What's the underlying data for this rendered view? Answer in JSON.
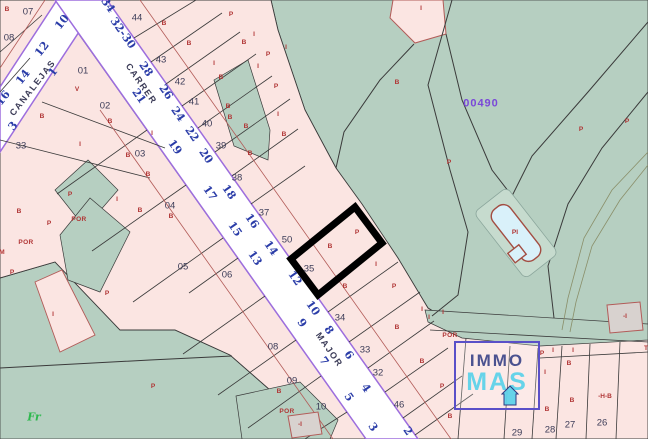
{
  "map": {
    "region_code": {
      "t": "00490",
      "x": 481,
      "y": 104
    },
    "street_names": [
      {
        "t": "CANALEJAS",
        "x": 33,
        "y": 88,
        "r": -52
      },
      {
        "t": "CARRER",
        "x": 141,
        "y": 84,
        "r": 55
      },
      {
        "t": "MAJOR",
        "x": 329,
        "y": 350,
        "r": 55
      }
    ],
    "house_numbers": [
      {
        "t": "34",
        "x": 108,
        "y": 5,
        "r": 55
      },
      {
        "t": "32-30",
        "x": 123,
        "y": 33,
        "r": 55
      },
      {
        "t": "28",
        "x": 146,
        "y": 69,
        "r": 55
      },
      {
        "t": "26",
        "x": 166,
        "y": 92,
        "r": 55
      },
      {
        "t": "24",
        "x": 178,
        "y": 114,
        "r": 55
      },
      {
        "t": "22",
        "x": 192,
        "y": 134,
        "r": 55
      },
      {
        "t": "20",
        "x": 206,
        "y": 156,
        "r": 55
      },
      {
        "t": "18",
        "x": 229,
        "y": 192,
        "r": 55
      },
      {
        "t": "16",
        "x": 252,
        "y": 221,
        "r": 55
      },
      {
        "t": "14",
        "x": 271,
        "y": 248,
        "r": 55
      },
      {
        "t": "12",
        "x": 295,
        "y": 278,
        "r": 55
      },
      {
        "t": "10",
        "x": 313,
        "y": 308,
        "r": 55
      },
      {
        "t": "8",
        "x": 329,
        "y": 330,
        "r": 55
      },
      {
        "t": "6",
        "x": 349,
        "y": 355,
        "r": 55
      },
      {
        "t": "4",
        "x": 366,
        "y": 388,
        "r": 55
      },
      {
        "t": "2",
        "x": 408,
        "y": 431,
        "r": 55
      },
      {
        "t": "21",
        "x": 139,
        "y": 96,
        "r": 55
      },
      {
        "t": "19",
        "x": 175,
        "y": 147,
        "r": 55
      },
      {
        "t": "17",
        "x": 210,
        "y": 193,
        "r": 55
      },
      {
        "t": "15",
        "x": 235,
        "y": 229,
        "r": 55
      },
      {
        "t": "13",
        "x": 255,
        "y": 258,
        "r": 55
      },
      {
        "t": "9",
        "x": 302,
        "y": 323,
        "r": 55
      },
      {
        "t": "7",
        "x": 324,
        "y": 361,
        "r": 55
      },
      {
        "t": "5",
        "x": 349,
        "y": 397,
        "r": 55
      },
      {
        "t": "3",
        "x": 373,
        "y": 427,
        "r": 55
      },
      {
        "t": "16",
        "x": 3,
        "y": 98,
        "r": -52
      },
      {
        "t": "14",
        "x": 23,
        "y": 77,
        "r": -52
      },
      {
        "t": "12",
        "x": 42,
        "y": 49,
        "r": -52
      },
      {
        "t": "10",
        "x": 62,
        "y": 22,
        "r": -52
      },
      {
        "t": "3",
        "x": 13,
        "y": 126,
        "r": -52
      },
      {
        "t": "1",
        "x": 53,
        "y": 72,
        "r": -52
      }
    ],
    "parcel_numbers": [
      {
        "t": "07",
        "x": 28,
        "y": 12
      },
      {
        "t": "08",
        "x": 9,
        "y": 38
      },
      {
        "t": "33",
        "x": 21,
        "y": 146
      },
      {
        "t": "01",
        "x": 83,
        "y": 71
      },
      {
        "t": "02",
        "x": 105,
        "y": 106
      },
      {
        "t": "03",
        "x": 140,
        "y": 154
      },
      {
        "t": "04",
        "x": 170,
        "y": 206
      },
      {
        "t": "05",
        "x": 183,
        "y": 267
      },
      {
        "t": "06",
        "x": 227,
        "y": 275
      },
      {
        "t": "08",
        "x": 273,
        "y": 347
      },
      {
        "t": "09",
        "x": 292,
        "y": 381
      },
      {
        "t": "10",
        "x": 321,
        "y": 407
      },
      {
        "t": "44",
        "x": 137,
        "y": 18
      },
      {
        "t": "43",
        "x": 161,
        "y": 60
      },
      {
        "t": "42",
        "x": 180,
        "y": 82
      },
      {
        "t": "41",
        "x": 194,
        "y": 102
      },
      {
        "t": "40",
        "x": 207,
        "y": 124
      },
      {
        "t": "39",
        "x": 221,
        "y": 146
      },
      {
        "t": "38",
        "x": 237,
        "y": 178
      },
      {
        "t": "37",
        "x": 264,
        "y": 213
      },
      {
        "t": "50",
        "x": 287,
        "y": 240
      },
      {
        "t": "35",
        "x": 309,
        "y": 269
      },
      {
        "t": "34",
        "x": 340,
        "y": 318
      },
      {
        "t": "33",
        "x": 365,
        "y": 350
      },
      {
        "t": "32",
        "x": 378,
        "y": 373
      },
      {
        "t": "46",
        "x": 399,
        "y": 405
      },
      {
        "t": "29",
        "x": 517,
        "y": 433
      },
      {
        "t": "28",
        "x": 550,
        "y": 430
      },
      {
        "t": "27",
        "x": 570,
        "y": 425
      },
      {
        "t": "26",
        "x": 602,
        "y": 423
      }
    ],
    "marks": [
      {
        "t": "B",
        "x": 7,
        "y": 10
      },
      {
        "t": "V",
        "x": 77,
        "y": 90
      },
      {
        "t": "B",
        "x": 42,
        "y": 117
      },
      {
        "t": "B",
        "x": 110,
        "y": 122
      },
      {
        "t": "I",
        "x": 152,
        "y": 134
      },
      {
        "t": "B",
        "x": 164,
        "y": 24
      },
      {
        "t": "B",
        "x": 189,
        "y": 44
      },
      {
        "t": "I",
        "x": 214,
        "y": 64
      },
      {
        "t": "B",
        "x": 230,
        "y": 118
      },
      {
        "t": "B",
        "x": 250,
        "y": 154
      },
      {
        "t": "I",
        "x": 80,
        "y": 145
      },
      {
        "t": "B",
        "x": 128,
        "y": 156
      },
      {
        "t": "B",
        "x": 148,
        "y": 175
      },
      {
        "t": "P",
        "x": 70,
        "y": 195
      },
      {
        "t": "B",
        "x": 19,
        "y": 212
      },
      {
        "t": "P",
        "x": 49,
        "y": 224
      },
      {
        "t": "B",
        "x": 140,
        "y": 211
      },
      {
        "t": "M",
        "x": 2,
        "y": 253
      },
      {
        "t": "P",
        "x": 12,
        "y": 273
      },
      {
        "t": "I",
        "x": 117,
        "y": 200
      },
      {
        "t": "B",
        "x": 171,
        "y": 217
      },
      {
        "t": "I",
        "x": 53,
        "y": 315
      },
      {
        "t": "P",
        "x": 107,
        "y": 294
      },
      {
        "t": "P",
        "x": 153,
        "y": 387
      },
      {
        "t": "I",
        "x": 421,
        "y": 9
      },
      {
        "t": "B",
        "x": 397,
        "y": 83
      },
      {
        "t": "P",
        "x": 449,
        "y": 163
      },
      {
        "t": "P",
        "x": 581,
        "y": 130
      },
      {
        "t": "P",
        "x": 627,
        "y": 122
      },
      {
        "t": "B",
        "x": 330,
        "y": 247
      },
      {
        "t": "P",
        "x": 357,
        "y": 233
      },
      {
        "t": "I",
        "x": 376,
        "y": 265
      },
      {
        "t": "B",
        "x": 345,
        "y": 287
      },
      {
        "t": "P",
        "x": 394,
        "y": 287
      },
      {
        "t": "I",
        "x": 443,
        "y": 313
      },
      {
        "t": "I",
        "x": 429,
        "y": 318
      },
      {
        "t": "B",
        "x": 397,
        "y": 328
      },
      {
        "t": "I",
        "x": 422,
        "y": 310
      },
      {
        "t": "P",
        "x": 542,
        "y": 354
      },
      {
        "t": "I",
        "x": 553,
        "y": 351
      },
      {
        "t": "B",
        "x": 569,
        "y": 364
      },
      {
        "t": "I",
        "x": 573,
        "y": 351
      },
      {
        "t": "T",
        "x": 646,
        "y": 349
      },
      {
        "t": "I",
        "x": 545,
        "y": 373
      },
      {
        "t": "B",
        "x": 572,
        "y": 401
      },
      {
        "t": "-H-B",
        "x": 605,
        "y": 397
      },
      {
        "t": "B",
        "x": 547,
        "y": 410
      },
      {
        "t": "P",
        "x": 442,
        "y": 387
      },
      {
        "t": "B",
        "x": 450,
        "y": 417
      },
      {
        "t": "B",
        "x": 279,
        "y": 392
      },
      {
        "t": "B",
        "x": 422,
        "y": 362
      },
      {
        "t": "P",
        "x": 231,
        "y": 15
      },
      {
        "t": "I",
        "x": 254,
        "y": 35
      },
      {
        "t": "B",
        "x": 244,
        "y": 43
      },
      {
        "t": "P",
        "x": 268,
        "y": 55
      },
      {
        "t": "I",
        "x": 286,
        "y": 48
      },
      {
        "t": "B",
        "x": 221,
        "y": 78
      },
      {
        "t": "I",
        "x": 258,
        "y": 67
      },
      {
        "t": "P",
        "x": 276,
        "y": 87
      },
      {
        "t": "B",
        "x": 228,
        "y": 107
      },
      {
        "t": "I",
        "x": 278,
        "y": 115
      },
      {
        "t": "B",
        "x": 246,
        "y": 127
      },
      {
        "t": "B",
        "x": 284,
        "y": 135
      },
      {
        "t": "-I",
        "x": 300,
        "y": 425
      },
      {
        "t": "-I",
        "x": 625,
        "y": 317
      }
    ],
    "por": [
      {
        "t": "POR",
        "x": 79,
        "y": 220
      },
      {
        "t": "POR",
        "x": 26,
        "y": 243
      },
      {
        "t": "POR",
        "x": 450,
        "y": 336
      },
      {
        "t": "POR",
        "x": 287,
        "y": 412
      }
    ],
    "misc_labels": [
      {
        "t": "Fr",
        "x": 34,
        "y": 417,
        "cls": "fr",
        "name": "fr-label"
      },
      {
        "t": "PI",
        "x": 515,
        "y": 233,
        "cls": "pi",
        "name": "pool-label"
      }
    ],
    "watermark": {
      "line1": "IMMO",
      "line2": "MAS"
    },
    "highlighted_parcel": "35",
    "colors": {
      "pink": "#fbe5e2",
      "green": "#b6cfc1",
      "navy": "#3c3c58",
      "blue": "#2b3da8",
      "red": "#b03434",
      "purple": "#7a48d8",
      "street_edge": "#9d6ede",
      "boundary": "#3a3a3a",
      "bldgline": "#b25b58",
      "frgreen": "#2db84d",
      "poolfill": "#d9f1fa",
      "poolrim": "#a34d42",
      "greybldg": "#d8d2cf",
      "wmborder": "#5a50c8",
      "wmnavy": "#25317d",
      "wmcyan": "#5ed2ea",
      "highlight": "#000000",
      "olive": "#8a8f6a"
    }
  }
}
